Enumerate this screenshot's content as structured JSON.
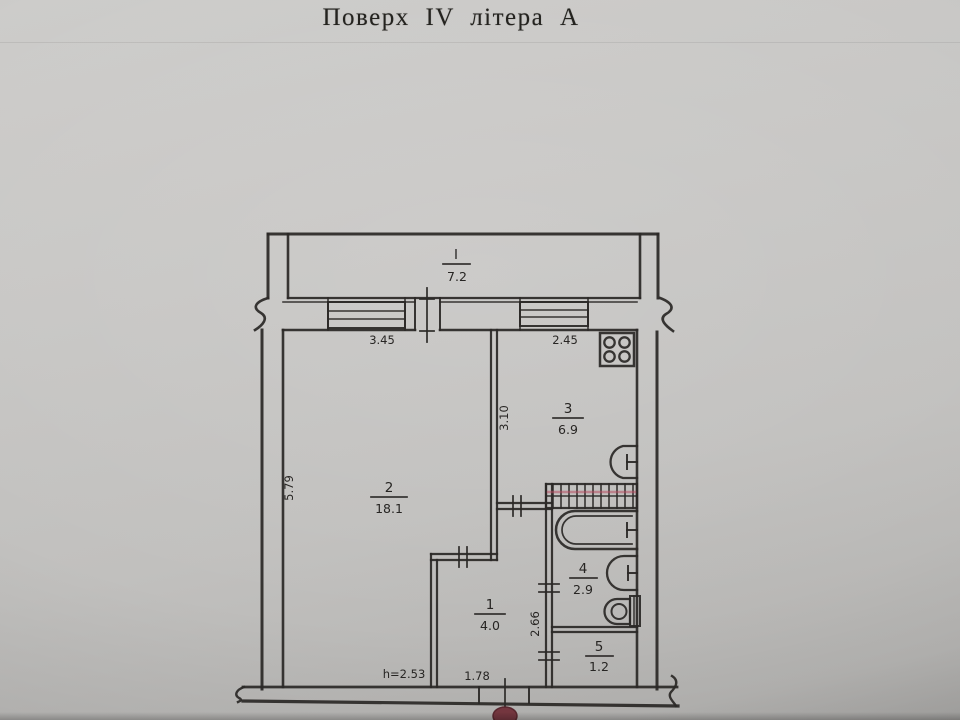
{
  "page": {
    "title": "Поверх IV літера А",
    "paper_color": "#c7c6c4",
    "ink_color": "#2b2927",
    "stamp_color": "#74363f"
  },
  "plan": {
    "rooms": [
      {
        "name": "balcony",
        "number": "I",
        "area": "7.2"
      },
      {
        "name": "living-room",
        "number": "2",
        "area": "18.1"
      },
      {
        "name": "kitchen",
        "number": "3",
        "area": "6.9"
      },
      {
        "name": "hallway",
        "number": "1",
        "area": "4.0"
      },
      {
        "name": "bathroom",
        "number": "4",
        "area": "2.9"
      },
      {
        "name": "wc",
        "number": "5",
        "area": "1.2"
      }
    ],
    "dimensions": {
      "living_width": "3.45",
      "kitchen_width": "2.45",
      "kitchen_depth": "3.10",
      "living_depth": "5.79",
      "bathroom_depth": "2.66",
      "hall_width": "1.78",
      "ceiling_height": "h=2.53"
    },
    "fixtures": [
      {
        "name": "stove-icon"
      },
      {
        "name": "kitchen-sink-icon"
      },
      {
        "name": "vent-grille-icon"
      },
      {
        "name": "bathtub-icon"
      },
      {
        "name": "washbasin-icon"
      },
      {
        "name": "toilet-icon"
      },
      {
        "name": "stamp-mark"
      }
    ]
  }
}
